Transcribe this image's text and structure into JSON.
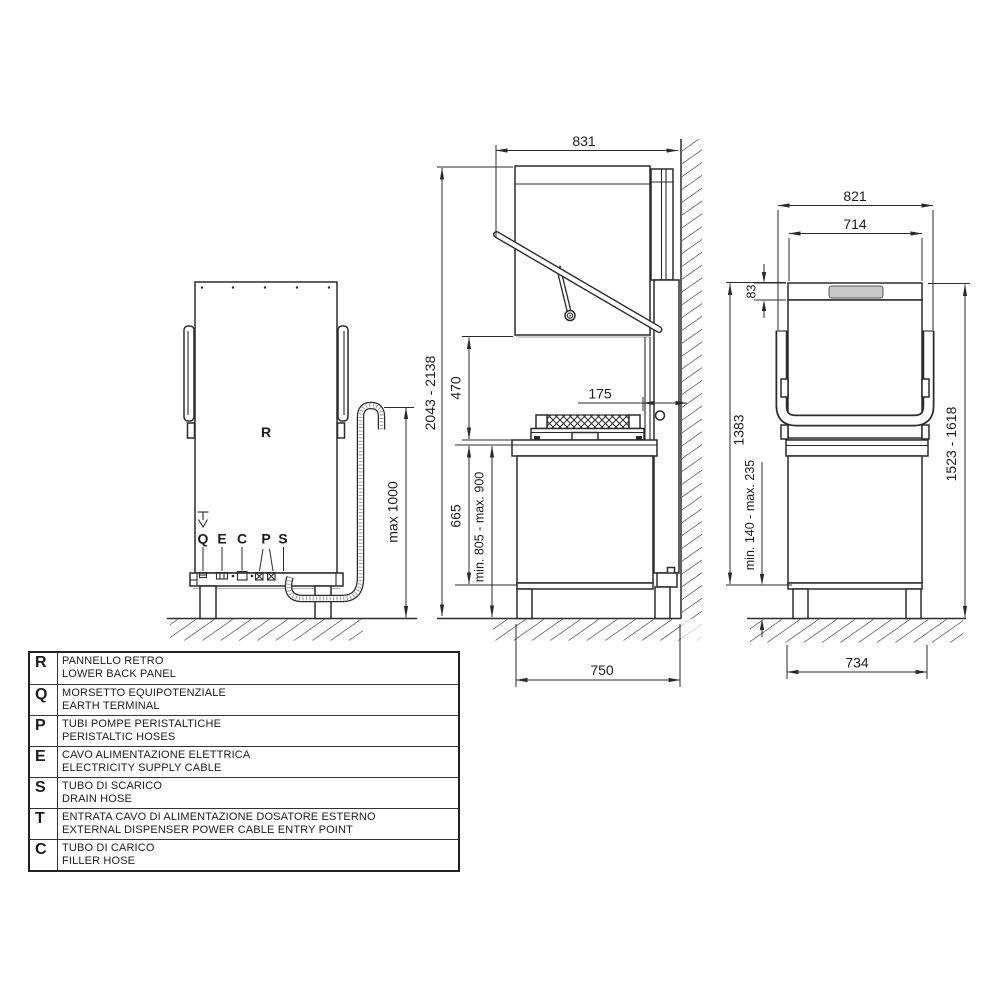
{
  "page": {
    "background": "#ffffff",
    "line_color": "#2b2b2b",
    "display_gray": "#c9c9c9",
    "shadow_gray": "#b5b5b5"
  },
  "views": {
    "back": {
      "panel_label": "R",
      "symbols": {
        "earth": "earth-ground-symbol",
        "drain": "drain-hose"
      },
      "connections": [
        {
          "label": "Q"
        },
        {
          "label": "E"
        },
        {
          "label": "C"
        },
        {
          "label": "P"
        },
        {
          "label": "S"
        }
      ],
      "dims": {
        "drain_max_height": "max 1000"
      }
    },
    "side": {
      "dims": {
        "total_height": "2043 - 2138",
        "width": "831",
        "hood_opening": "470",
        "counter_height": "665",
        "loading_height": "min. 805 - max. 900",
        "depth": "750",
        "wall_distance": "175"
      }
    },
    "front": {
      "dims": {
        "overall_width": "821",
        "body_width": "714",
        "top_panel": "83",
        "closed_height": "1383",
        "open_height": "1523 - 1618",
        "feet_range": "min. 140 - max. 235",
        "base_width": "734"
      }
    }
  },
  "legend": {
    "rows": [
      {
        "letter": "R",
        "it": "PANNELLO RETRO",
        "en": "LOWER BACK PANEL"
      },
      {
        "letter": "Q",
        "it": "MORSETTO EQUIPOTENZIALE",
        "en": "EARTH TERMINAL"
      },
      {
        "letter": "P",
        "it": "TUBI POMPE PERISTALTICHE",
        "en": "PERISTALTIC HOSES"
      },
      {
        "letter": "E",
        "it": "CAVO ALIMENTAZIONE ELETTRICA",
        "en": "ELECTRICITY SUPPLY CABLE"
      },
      {
        "letter": "S",
        "it": "TUBO DI SCARICO",
        "en": "DRAIN HOSE"
      },
      {
        "letter": "T",
        "it": "ENTRATA CAVO DI ALIMENTAZIONE DOSATORE ESTERNO",
        "en": "EXTERNAL DISPENSER POWER CABLE ENTRY POINT"
      },
      {
        "letter": "C",
        "it": "TUBO DI CARICO",
        "en": "FILLER HOSE"
      }
    ]
  }
}
